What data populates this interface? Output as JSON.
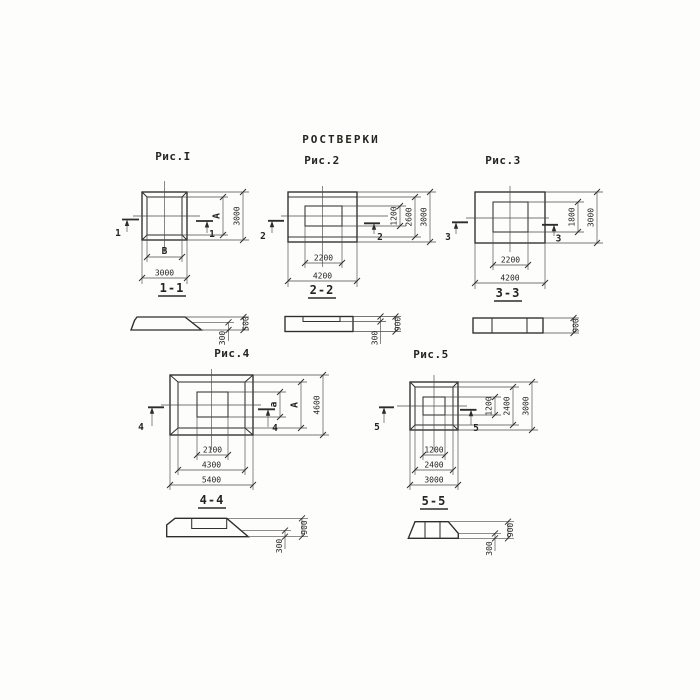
{
  "title": "РОСТВЕРКИ",
  "colors": {
    "ink": "#2f2d2a",
    "paper": "#fdfdfc"
  },
  "figures": {
    "fig1": {
      "caption": "Рис.I",
      "marker": "1",
      "section_label": "1-1",
      "dims": {
        "inner_width": "В",
        "outer_width": "3000",
        "inner_height": "А",
        "outer_height": "3000"
      },
      "section_dims": {
        "total_height": "500",
        "edge_height": "300"
      }
    },
    "fig2": {
      "caption": "Рис.2",
      "marker": "2",
      "section_label": "2-2",
      "dims": {
        "inner_width": "2200",
        "outer_width": "4200",
        "inner_height": "1200",
        "mid_height": "2600",
        "outer_height": "3000"
      },
      "section_dims": {
        "total_height": "900",
        "edge_height": "300"
      }
    },
    "fig3": {
      "caption": "Рис.3",
      "marker": "3",
      "section_label": "3-3",
      "dims": {
        "inner_width": "2200",
        "outer_width": "4200",
        "inner_height": "1800",
        "outer_height": "3000"
      },
      "section_dims": {
        "total_height": "900"
      }
    },
    "fig4": {
      "caption": "Рис.4",
      "marker": "4",
      "section_label": "4-4",
      "dims": {
        "inner_width": "2100",
        "mid_width": "4300",
        "outer_width": "5400",
        "inner_height": "а",
        "mid_height": "А",
        "outer_height": "4600"
      },
      "section_dims": {
        "total_height": "900",
        "edge_height": "300"
      }
    },
    "fig5": {
      "caption": "Рис.5",
      "marker": "5",
      "section_label": "5-5",
      "dims": {
        "inner_width": "1200",
        "mid_width": "2400",
        "outer_width": "3000",
        "inner_height": "1200",
        "mid_height": "2400",
        "outer_height": "3000"
      },
      "section_dims": {
        "total_height": "900",
        "edge_height": "300"
      }
    }
  }
}
